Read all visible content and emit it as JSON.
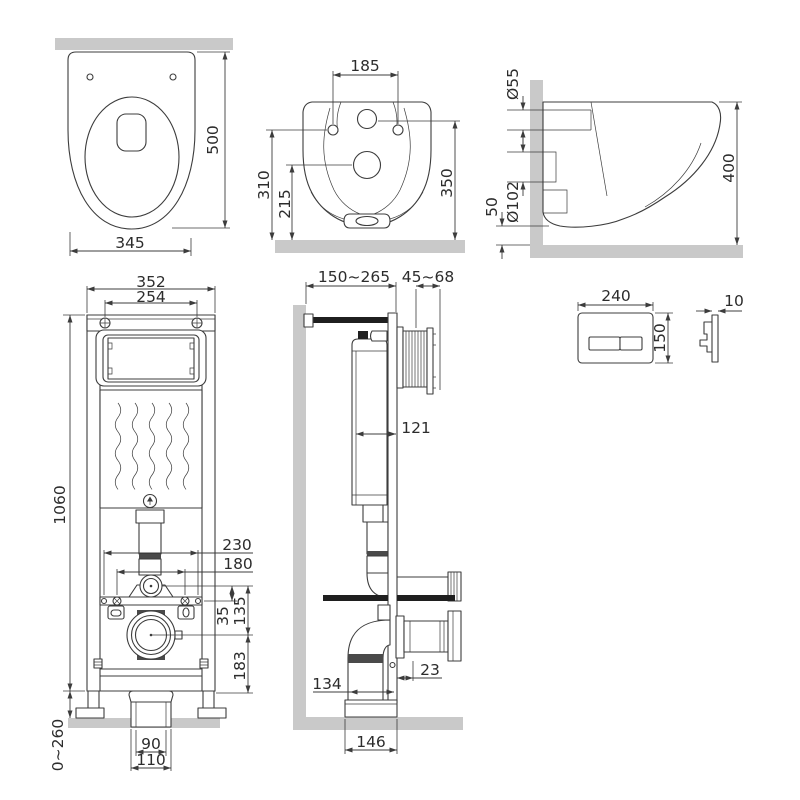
{
  "drawing_title": "Wall-hung toilet with installation frame — dimensional drawing",
  "views": {
    "toilet_top": {
      "width": "345",
      "length": "500"
    },
    "toilet_rear": {
      "hole_spacing": "185",
      "bowl_height": "310",
      "outlet_height": "215",
      "total_height": "350"
    },
    "toilet_side": {
      "inlet_dia": "Ø55",
      "outlet_dia": "Ø102",
      "clearance": "50",
      "height_overall": "400"
    },
    "frame_front": {
      "width": "352",
      "bolt_spacing": "254",
      "height": "1060",
      "fixing_outer": "230",
      "fixing_inner": "180",
      "offset_a": "35",
      "offset_b": "135",
      "offset_c": "183",
      "leg_adjust": "0~260",
      "drain_inner": "90",
      "drain_outer": "110"
    },
    "frame_side": {
      "wall_distance": "150~265",
      "sleeve_range": "45~68",
      "depth": "121",
      "drain_offset": "134",
      "gap": "23",
      "base_depth": "146"
    },
    "flush_plate": {
      "width": "240",
      "height": "150",
      "thickness": "10"
    }
  }
}
